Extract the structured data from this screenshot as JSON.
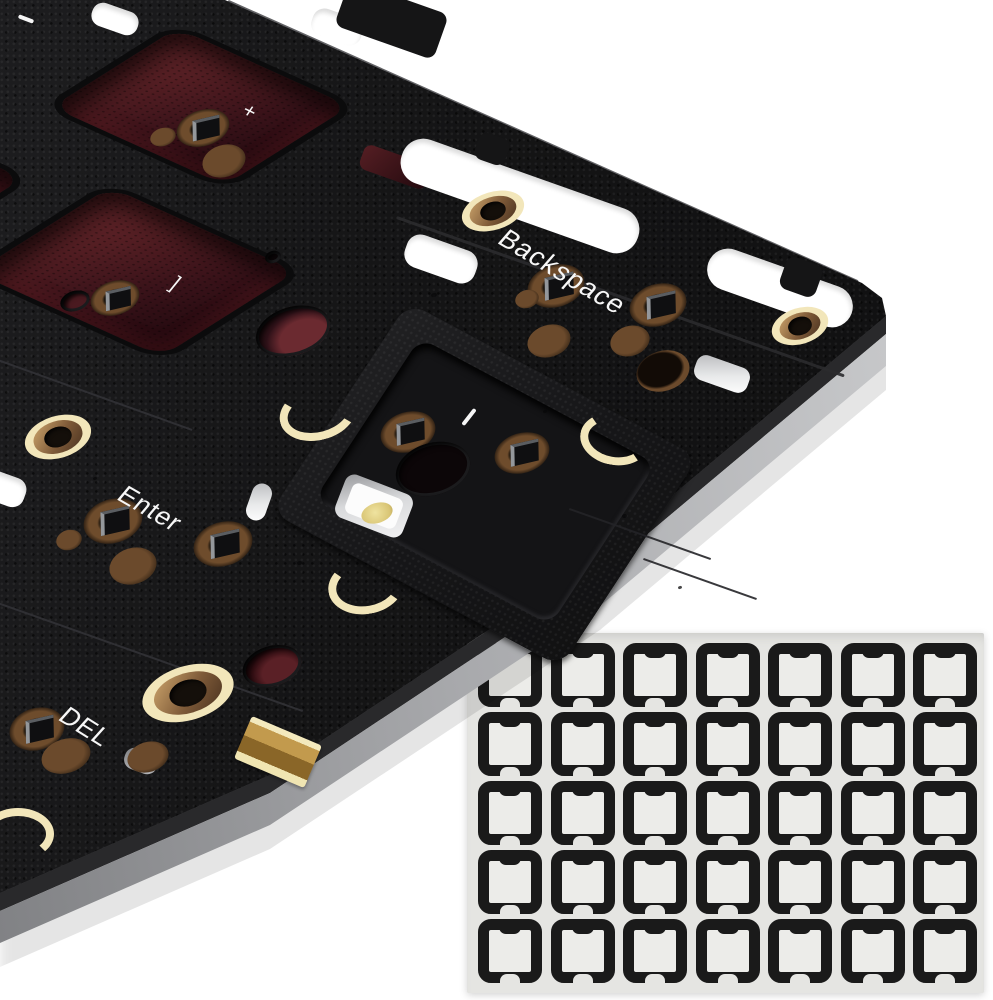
{
  "meta": {
    "description": "Product photo: exploded view of a black keyboard switch plate and PCB with brass standoffs, red switch cutouts and silkscreen key legends, above a sheet of black switch pad stickers on white background"
  },
  "board": {
    "legend_backspace": "Backspace",
    "legend_enter": "Enter",
    "legend_del": "DEL",
    "legend_plus": "+",
    "legend_bracket": "]",
    "colors": {
      "plate_black": "#161617",
      "cutout_red": "#5a2026",
      "standoff_cream": "#f2e6ba",
      "standoff_brass": "#7e5a38",
      "side_edge_gray": "#a9aaad",
      "gold_connector": "#c29a4d",
      "led_yellow": "#e8d98a"
    }
  },
  "sticker_sheet": {
    "rows": 5,
    "cols": 7,
    "count": 35,
    "sheet_color": "#e5e5e2",
    "pad_color": "#1a1a1a"
  }
}
